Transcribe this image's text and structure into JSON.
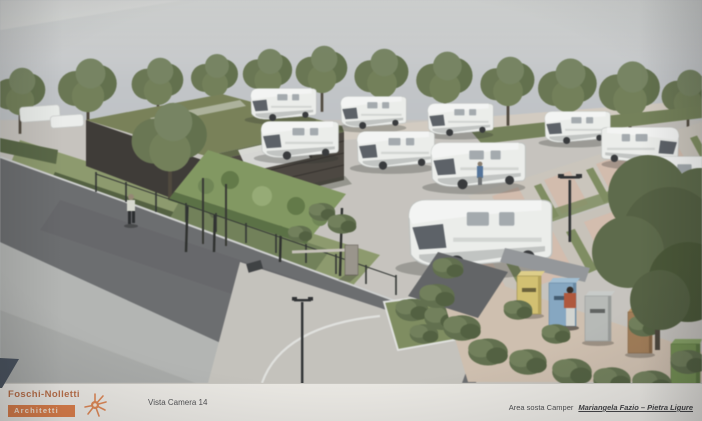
{
  "title_block": {
    "firm_name": "Foschi-Nolletti",
    "firm_subtitle": "Architetti",
    "view_label": "Vista Camera 14",
    "project_prefix": "Area  sosta Camper",
    "project_name": "Mariangela Fazio – Pietra Ligure"
  },
  "colors": {
    "sky_top": "#d6d8d6",
    "sky": "#bfc4c8",
    "paper": "#e9e7e2",
    "logo_orange": "#d8743c",
    "logo_text_orange": "#b0592d",
    "title_text": "#37383b",
    "tree_green": "#66764a",
    "lawn_green": "#8b9b63",
    "asphalt": "#6a6c6f",
    "sidewalk": "#b3b6b3",
    "concrete": "#c8c5be",
    "parking_pad_pink": "#d8bcaa",
    "camper_white": "#eef0ed",
    "corner_triangle": "#4a535f",
    "bin_yellow": "#d9c25e",
    "bin_blue": "#7fa8c9",
    "bin_gray": "#b7bbb8",
    "bin_brown": "#a87a4b",
    "bin_green": "#6f9345"
  },
  "scene": {
    "elements": [
      "tree-row",
      "campers",
      "service-building",
      "vine-pergola",
      "entrance-barrier",
      "street-lamps",
      "pedestrians",
      "recycling-bins",
      "parking-pads",
      "access-road",
      "sidewalk",
      "entry-plaza",
      "planting-island",
      "foreground-tree"
    ]
  }
}
